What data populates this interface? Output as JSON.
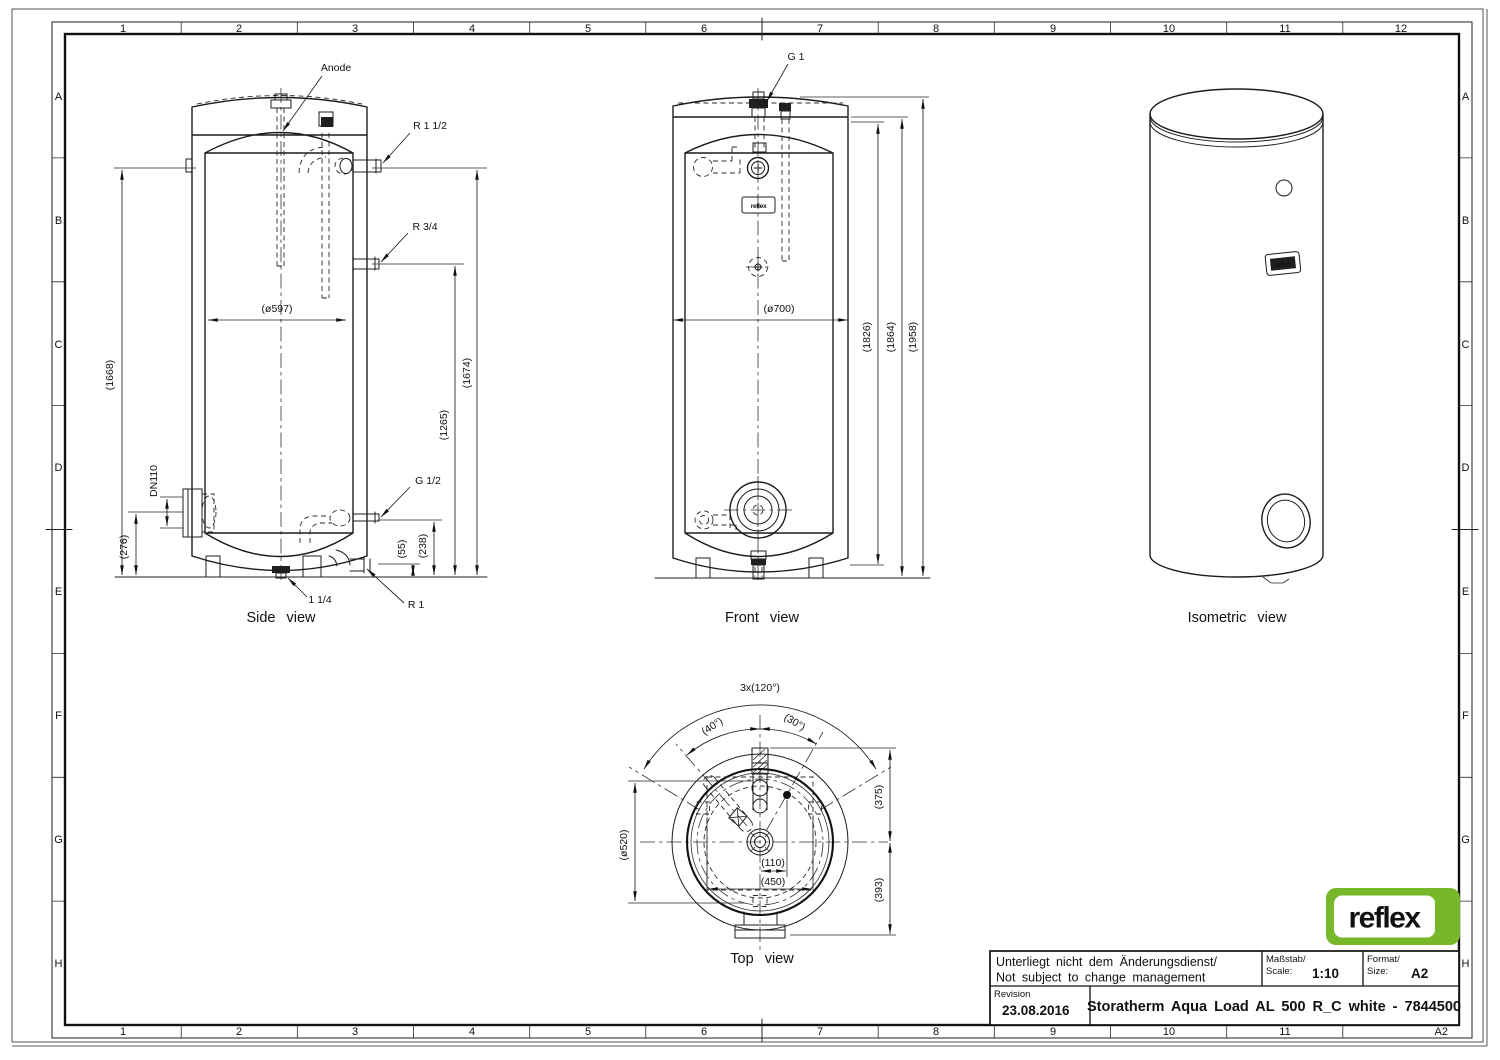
{
  "sheet": {
    "cols": [
      "1",
      "2",
      "3",
      "4",
      "5",
      "6",
      "7",
      "8",
      "9",
      "10",
      "11",
      "12"
    ],
    "rows": [
      "A",
      "B",
      "C",
      "D",
      "E",
      "F",
      "G",
      "H"
    ],
    "corner_cell": "A2"
  },
  "logo": {
    "text": "reflex",
    "green": "#76b82a"
  },
  "views": {
    "side": {
      "caption": "Side view",
      "anode": "Anode",
      "fit_r112": "R 1 1/2",
      "fit_r34": "R 3/4",
      "fit_g12": "G 1/2",
      "fit_r1": "R 1",
      "fit_114": "1 1/4",
      "fit_dn110": "DN110",
      "dim_d597": "(ø597)",
      "dim_1668": "(1668)",
      "dim_1674": "(1674)",
      "dim_1265": "(1265)",
      "dim_276": "(276)",
      "dim_238": "(238)",
      "dim_55": "(55)"
    },
    "front": {
      "caption": "Front view",
      "fit_g1": "G 1",
      "dim_d700": "(ø700)",
      "dim_1826": "(1826)",
      "dim_1864": "(1864)",
      "dim_1958": "(1958)"
    },
    "iso": {
      "caption": "Isometric view"
    },
    "top": {
      "caption": "Top view",
      "dim_3x120": "3x(120°)",
      "dim_40": "(40°)",
      "dim_30": "(30°)",
      "dim_d520": "(ø520)",
      "dim_375": "(375)",
      "dim_393": "(393)",
      "dim_110": "(110)",
      "dim_450": "(450)"
    }
  },
  "title_block": {
    "note_de": "Unterliegt nicht dem Änderungsdienst/",
    "note_en": "Not subject to change management",
    "scale_label_de": "Maßstab/",
    "scale_label_en": "Scale:",
    "scale_value": "1:10",
    "format_label_de": "Format/",
    "format_label_en": "Size:",
    "format_value": "A2",
    "revision_label": "Revision",
    "revision_date": "23.08.2016",
    "drawing_title": "Storatherm Aqua Load AL 500 R_C white - 7844500"
  }
}
